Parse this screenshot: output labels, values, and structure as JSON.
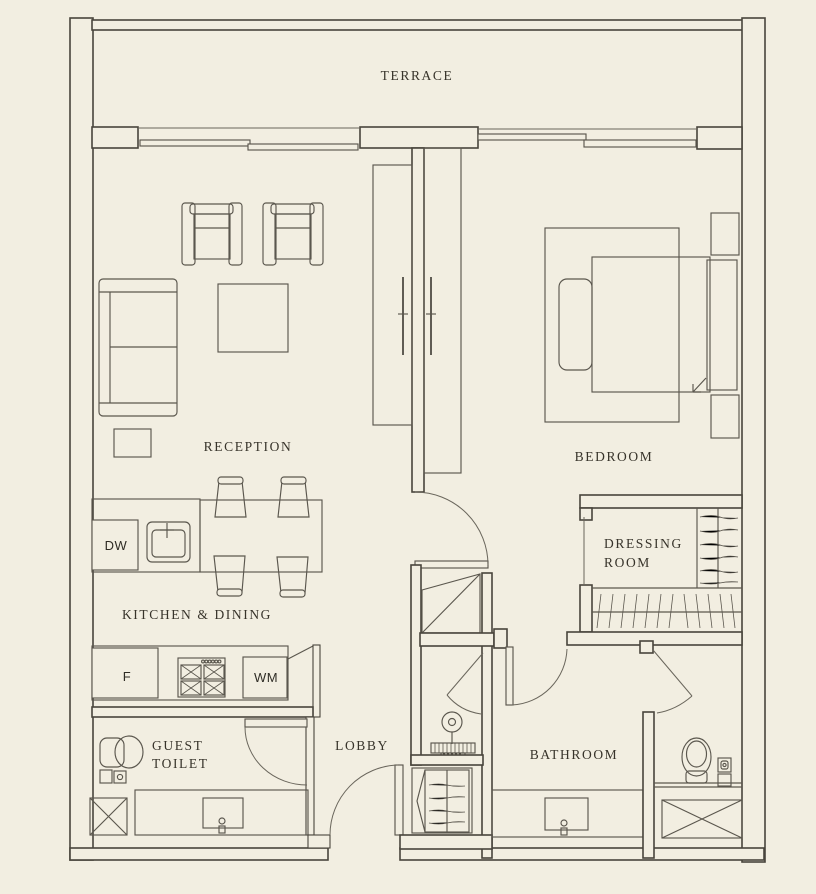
{
  "palette": {
    "background": "#f2eee1",
    "line": "#49453c",
    "furniture_line": "#5b574e",
    "text": "#37332a"
  },
  "rooms": {
    "terrace": {
      "label": "TERRACE"
    },
    "reception": {
      "label": "RECEPTION"
    },
    "bedroom": {
      "label": "BEDROOM"
    },
    "dressing_room": {
      "line1": "DRESSING",
      "line2": "ROOM"
    },
    "kitchen_dining": {
      "label": "KITCHEN & DINING"
    },
    "guest_toilet": {
      "line1": "GUEST",
      "line2": "TOILET"
    },
    "lobby": {
      "label": "LOBBY"
    },
    "bathroom": {
      "label": "BATHROOM"
    }
  },
  "appliances": {
    "dishwasher": "DW",
    "fridge": "F",
    "washing_machine": "WM"
  }
}
